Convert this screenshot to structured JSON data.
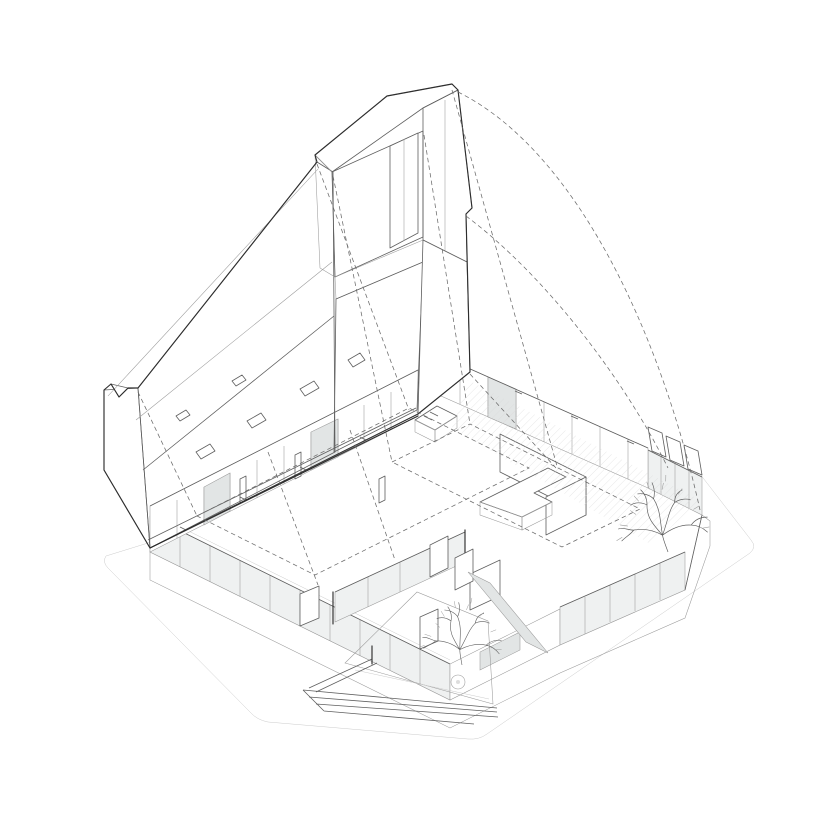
{
  "meta": {
    "description": "Exploded axonometric line drawing of an L-shaped single-storey house: a lifted timber roof plane with exposed rafters and a louvered tower volume hovers above the open floor plan; glazed facades, interior partitions, an L-shaped island, a recessed entry court with steps, a paving circle and two leafless trees; dashed projection lines and arcs link the roof to the plan.",
    "background": "#ffffff"
  },
  "palette": {
    "bg": "#ffffff",
    "line-dark": "#2e2e2e",
    "line-mid": "#5f5f5f",
    "line-light": "#9a9a9a",
    "line-faint": "#cbcbcb",
    "dash": "#6b6b6b",
    "fill-white": "#ffffff",
    "fill-glass": "#eff1f1",
    "fill-glass-dark": "#e2e5e5",
    "fill-plinth": "#e9e9e9",
    "fill-hatch-band": "#ececec",
    "hatch-ground": "#e4e4e4",
    "hatch-shadow": "#d9d9d9",
    "hatch-dense": "#b0b0b0",
    "rafter-line": "#8f8f8f",
    "louver-line": "#9d9d9d"
  }
}
